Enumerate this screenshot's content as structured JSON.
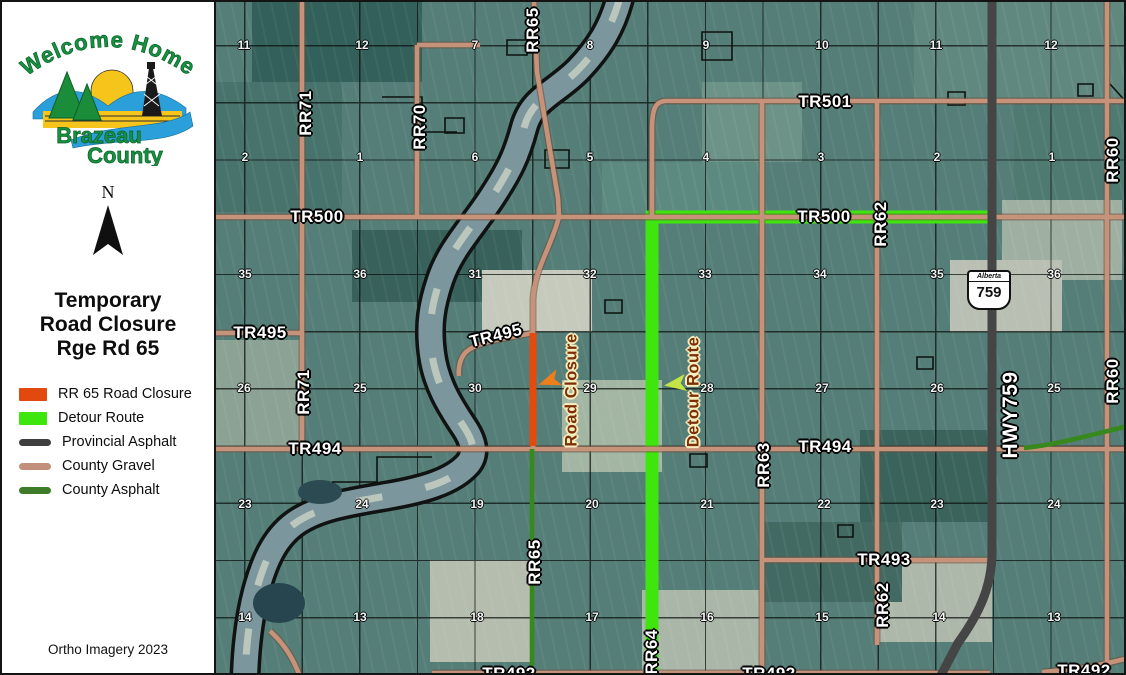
{
  "panel": {
    "logo": {
      "arc_text": "Welcome Home",
      "name1": "Brazeau",
      "name2": "County"
    },
    "north_label": "N",
    "title_lines": [
      "Temporary",
      "Road Closure",
      "Rge Rd 65"
    ],
    "legend": [
      {
        "label": "RR 65 Road Closure",
        "style": "rect",
        "color": "#e1490e"
      },
      {
        "label": "Detour Route",
        "style": "rect",
        "color": "#3fe60e"
      },
      {
        "label": "Provincial Asphalt",
        "style": "line",
        "color": "#3f3f3f"
      },
      {
        "label": "County Gravel",
        "style": "line",
        "color": "#c28f7b"
      },
      {
        "label": "County Asphalt",
        "style": "line",
        "color": "#3d7d2a"
      }
    ],
    "credit": "Ortho Imagery 2023"
  },
  "map": {
    "shield": {
      "region": "Alberta",
      "number": "759"
    },
    "road_labels": [
      {
        "t": "TR501",
        "x": 823,
        "y": 100
      },
      {
        "t": "TR500",
        "x": 315,
        "y": 215
      },
      {
        "t": "TR500",
        "x": 822,
        "y": 215
      },
      {
        "t": "TR495",
        "x": 258,
        "y": 331
      },
      {
        "t": "TR495",
        "x": 494,
        "y": 334,
        "rot": -14
      },
      {
        "t": "TR494",
        "x": 313,
        "y": 447
      },
      {
        "t": "TR494",
        "x": 823,
        "y": 445
      },
      {
        "t": "TR493",
        "x": 882,
        "y": 558
      },
      {
        "t": "TR492",
        "x": 507,
        "y": 672
      },
      {
        "t": "TR492",
        "x": 767,
        "y": 672
      },
      {
        "t": "TR492",
        "x": 1082,
        "y": 669
      },
      {
        "t": "RR71",
        "x": 304,
        "y": 111,
        "rot": -90
      },
      {
        "t": "RR71",
        "x": 302,
        "y": 390,
        "rot": -90
      },
      {
        "t": "RR70",
        "x": 418,
        "y": 125,
        "rot": -90
      },
      {
        "t": "RR65",
        "x": 531,
        "y": 28,
        "rot": -90
      },
      {
        "t": "RR65",
        "x": 533,
        "y": 560,
        "rot": -90
      },
      {
        "t": "RR64",
        "x": 650,
        "y": 650,
        "rot": -90
      },
      {
        "t": "RR63",
        "x": 762,
        "y": 463,
        "rot": -90
      },
      {
        "t": "RR62",
        "x": 879,
        "y": 222,
        "rot": -90
      },
      {
        "t": "RR62",
        "x": 881,
        "y": 603,
        "rot": -90
      },
      {
        "t": "RR60",
        "x": 1111,
        "y": 158,
        "rot": -90
      },
      {
        "t": "RR60",
        "x": 1111,
        "y": 379,
        "rot": -90
      },
      {
        "t": "HWY759",
        "x": 1009,
        "y": 413,
        "rot": -90,
        "size": "lg"
      }
    ],
    "section_rows": [
      {
        "y": 43,
        "cells": [
          [
            "11",
            242
          ],
          [
            "12",
            360
          ],
          [
            "7",
            473
          ],
          [
            "8",
            588
          ],
          [
            "9",
            704
          ],
          [
            "10",
            820
          ],
          [
            "11",
            934
          ],
          [
            "12",
            1049
          ]
        ]
      },
      {
        "y": 155,
        "cells": [
          [
            "2",
            243
          ],
          [
            "1",
            358
          ],
          [
            "6",
            473
          ],
          [
            "5",
            588
          ],
          [
            "4",
            704
          ],
          [
            "3",
            819
          ],
          [
            "2",
            935
          ],
          [
            "1",
            1050
          ]
        ]
      },
      {
        "y": 272,
        "cells": [
          [
            "35",
            243
          ],
          [
            "36",
            358
          ],
          [
            "31",
            473
          ],
          [
            "32",
            588
          ],
          [
            "33",
            703
          ],
          [
            "34",
            818
          ],
          [
            "35",
            935
          ],
          [
            "36",
            1052
          ]
        ]
      },
      {
        "y": 386,
        "cells": [
          [
            "26",
            242
          ],
          [
            "25",
            358
          ],
          [
            "30",
            473
          ],
          [
            "29",
            588
          ],
          [
            "28",
            705
          ],
          [
            "27",
            820
          ],
          [
            "26",
            935
          ],
          [
            "25",
            1052
          ]
        ]
      },
      {
        "y": 502,
        "cells": [
          [
            "23",
            243
          ],
          [
            "24",
            360
          ],
          [
            "19",
            475
          ],
          [
            "20",
            590
          ],
          [
            "21",
            705
          ],
          [
            "22",
            822
          ],
          [
            "23",
            935
          ],
          [
            "24",
            1052
          ]
        ]
      },
      {
        "y": 615,
        "cells": [
          [
            "14",
            243
          ],
          [
            "13",
            358
          ],
          [
            "18",
            475
          ],
          [
            "17",
            590
          ],
          [
            "16",
            705
          ],
          [
            "15",
            820
          ],
          [
            "14",
            937
          ],
          [
            "13",
            1052
          ]
        ]
      }
    ],
    "annotations": [
      {
        "t": "Road Closure",
        "x": 570,
        "y": 388,
        "rot": -90,
        "ax": 547,
        "ay": 379,
        "arot": -20,
        "afill": "#ee7d1b"
      },
      {
        "t": "Detour Route",
        "x": 692,
        "y": 390,
        "rot": -90,
        "ax": 673,
        "ay": 382,
        "arot": -8,
        "afill": "#c3e443"
      }
    ],
    "colors": {
      "closure": "#e4490e",
      "detour": "#3fe60e",
      "provincial_asphalt": "#454545",
      "county_gravel": "#c6937a",
      "county_asphalt": "#37891d"
    }
  }
}
